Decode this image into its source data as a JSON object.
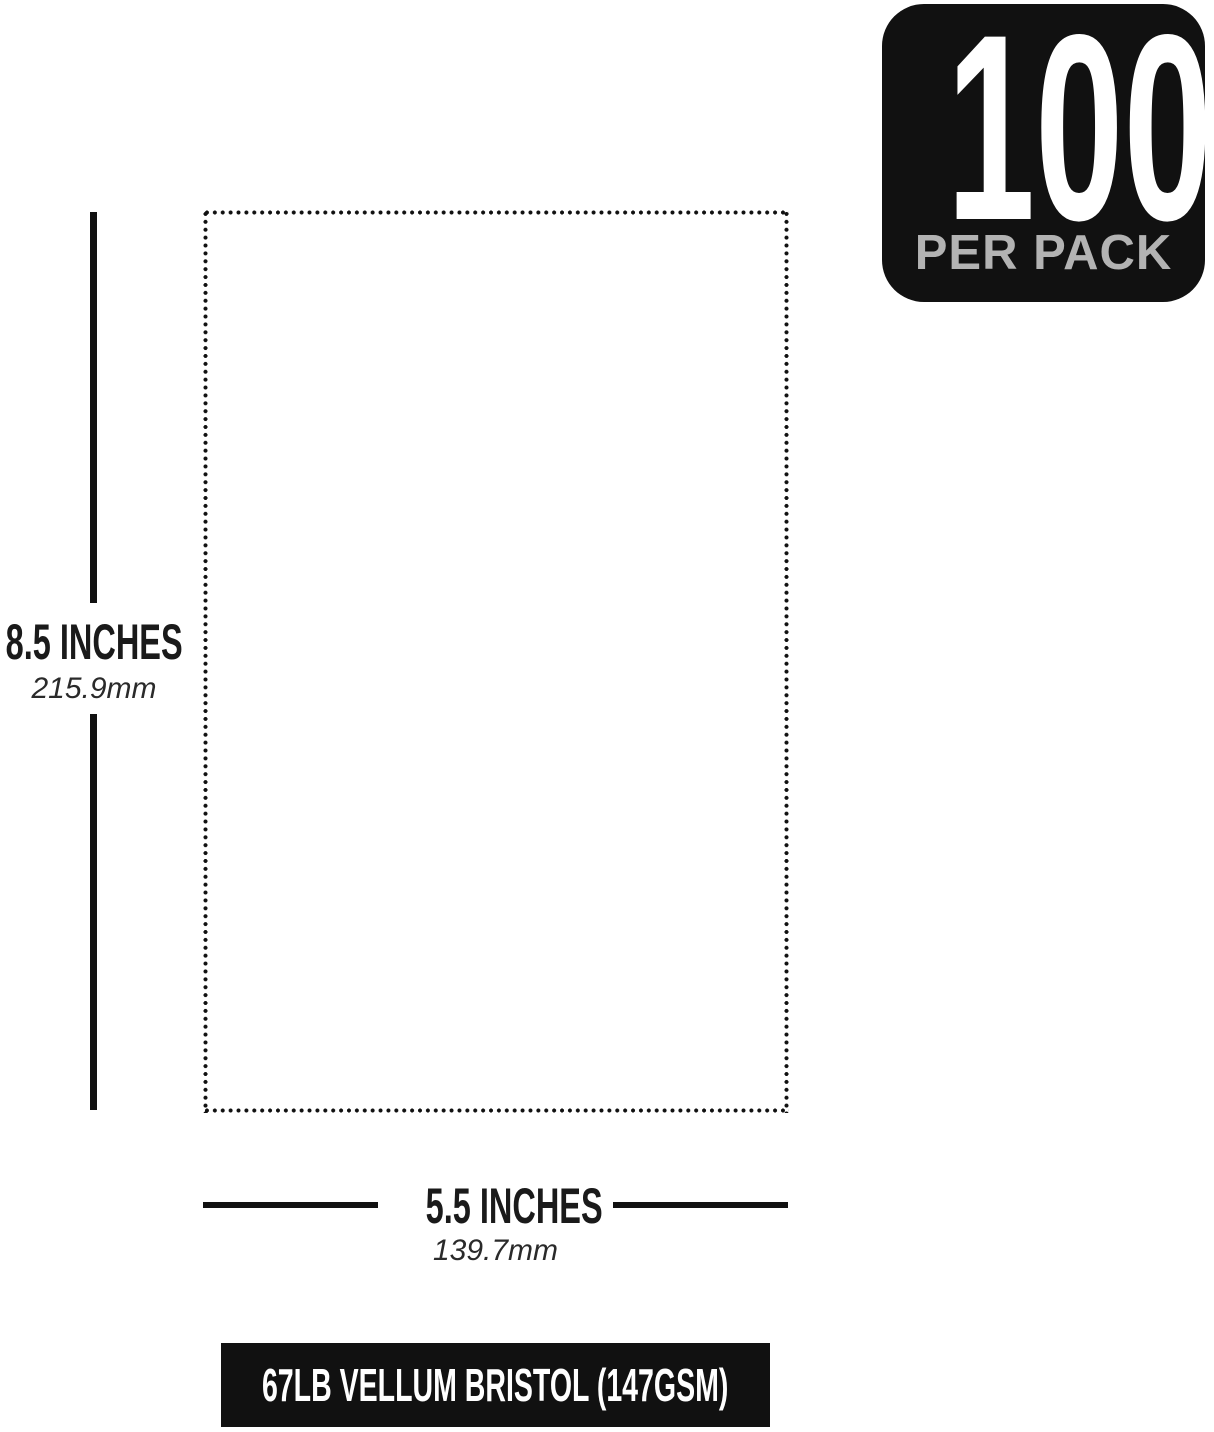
{
  "badge": {
    "count": "100",
    "label": "PER PACK",
    "bg_color": "#111111",
    "count_color": "#ffffff",
    "label_color": "#b3b3b3"
  },
  "height_dimension": {
    "inches": "8.5 INCHES",
    "mm": "215.9mm"
  },
  "width_dimension": {
    "inches": "5.5 INCHES",
    "mm": "139.7mm"
  },
  "banner": {
    "text": "67LB VELLUM BRISTOL (147GSM)",
    "bg_color": "#111111",
    "text_color": "#ffffff"
  },
  "outline_color": "#111111",
  "line_color": "#111111",
  "background_color": "#ffffff"
}
